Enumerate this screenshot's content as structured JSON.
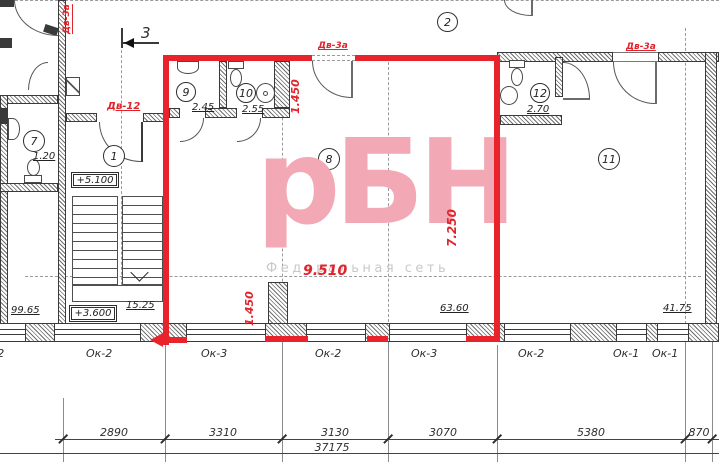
{
  "watermark": {
    "logo": "рБН",
    "tagline": "Федеральная сеть"
  },
  "colors": {
    "accent_red": "#e8232b",
    "watermark_pink": "#f2a9b5",
    "line": "#3a3a3a"
  },
  "axes": {
    "bubble2": "2",
    "section3": "3"
  },
  "doors": {
    "top_left": "Дв-3а",
    "mid": "Дв-3а",
    "right": "Дв-3а",
    "room1": "Дв-12"
  },
  "rooms": {
    "r1": {
      "num": "1"
    },
    "r7": {
      "num": "7",
      "area": "1.20"
    },
    "r8": {
      "num": "8"
    },
    "r9": {
      "num": "9",
      "area": "2.45"
    },
    "r10": {
      "num": "10",
      "area": "2.55"
    },
    "r11": {
      "num": "11"
    },
    "r12": {
      "num": "12",
      "area": "2.70"
    }
  },
  "elevations": {
    "upper": "+5.100",
    "lower": "+3.600"
  },
  "areas": {
    "corridor": "99.65",
    "stair": "15.25",
    "hall": "63.60",
    "right": "41.75"
  },
  "red_dims": {
    "top": "1.450",
    "bottom": "1.450",
    "width": "9.510",
    "height": "7.250"
  },
  "windows": {
    "w0": "Ок-2",
    "w1": "Ок-2",
    "w2": "Ок-3",
    "w3": "Ок-2",
    "w4": "Ок-3",
    "w5": "Ок-2",
    "w6": "Ок-1",
    "w7": "Ок-1"
  },
  "dims": {
    "s1": "2890",
    "s2": "3310",
    "s3": "3130",
    "s4": "3070",
    "s5": "5380",
    "s6": "870",
    "total": "37175"
  }
}
